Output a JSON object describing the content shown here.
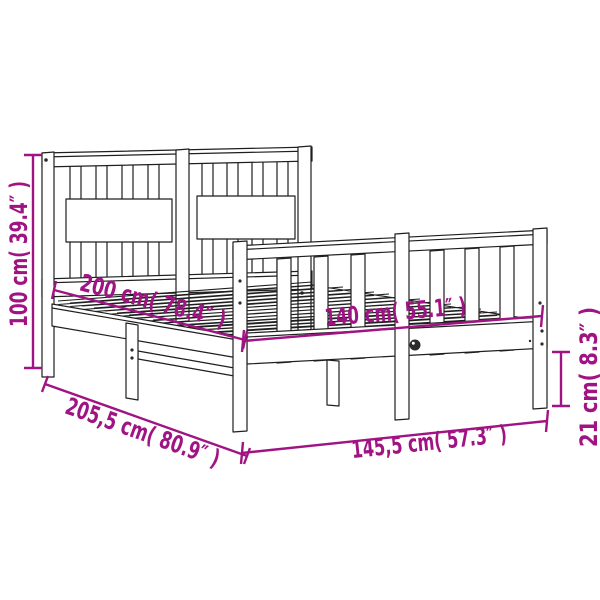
{
  "colors": {
    "dimension": "#A01383",
    "line": "#1f1f1f",
    "background": "#ffffff"
  },
  "diagram": {
    "subject": "bed-frame-with-headboard-dimension-diagram",
    "dimensions": {
      "height": "100 cm( 39.4″ )",
      "length_inner": "200 cm( 78.4″ )",
      "width_inner": "140 cm( 55.1″ )",
      "side_rail_height": "21 cm( 8.3″ )",
      "length_outer": "205,5 cm( 80.9″ )",
      "width_outer": "145,5 cm( 57.3″ )"
    }
  }
}
